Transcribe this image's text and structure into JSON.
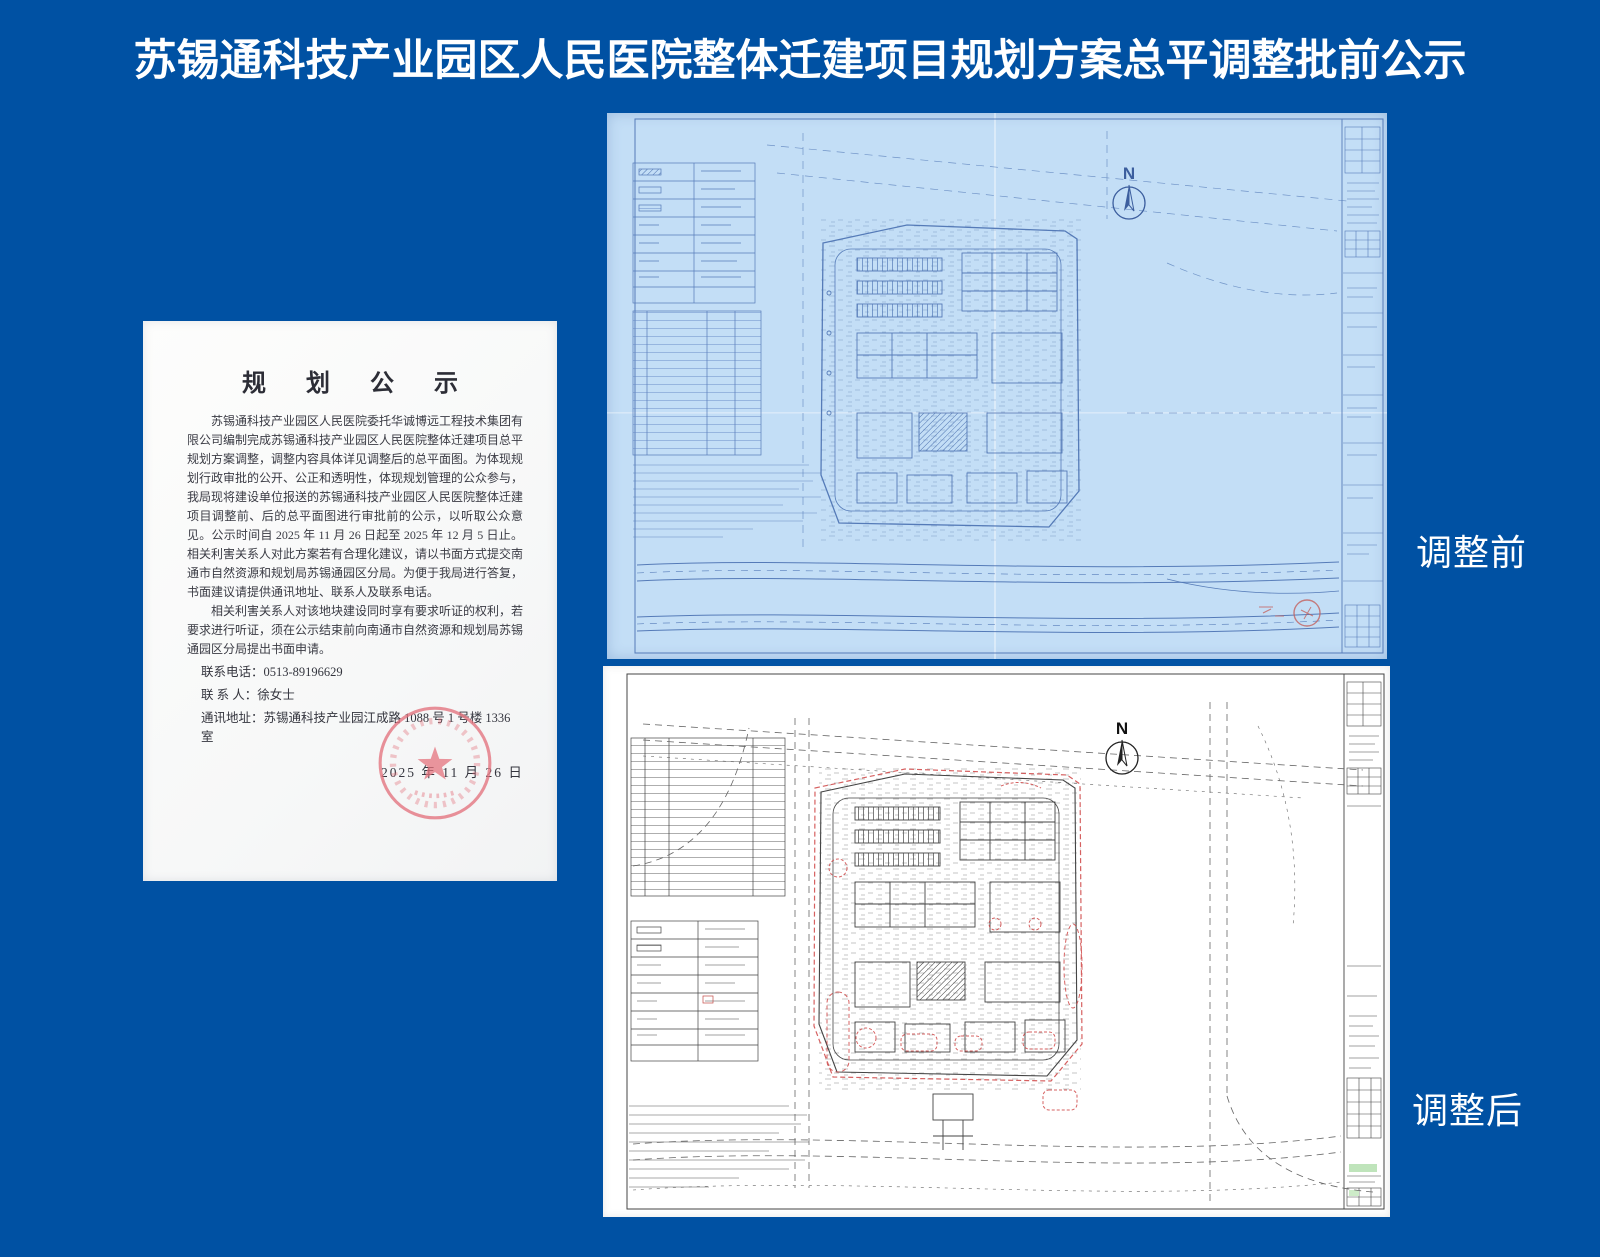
{
  "page": {
    "title": "苏锡通科技产业园区人民医院整体迁建项目规划方案总平调整批前公示",
    "background_color": "#0051a3"
  },
  "notice_letter": {
    "heading": "规 划 公 示",
    "paragraphs": [
      "苏锡通科技产业园区人民医院委托华诚博远工程技术集团有限公司编制完成苏锡通科技产业园区人民医院整体迁建项目总平规划方案调整，调整内容具体详见调整后的总平面图。为体现规划行政审批的公开、公正和透明性，体现规划管理的公众参与，我局现将建设单位报送的苏锡通科技产业园区人民医院整体迁建项目调整前、后的总平面图进行审批前的公示，以听取公众意见。公示时间自 2025 年 11 月 26 日起至 2025 年 12 月 5 日止。相关利害关系人对此方案若有合理化建议，请以书面方式提交南通市自然资源和规划局苏锡通园区分局。为便于我局进行答复，书面建议请提供通讯地址、联系人及联系电话。",
      "相关利害关系人对该地块建设同时享有要求听证的权利，若要求进行听证，须在公示结束前向南通市自然资源和规划局苏锡通园区分局提出书面申请。"
    ],
    "contact_phone": "联系电话：0513-89196629",
    "contact_person": "联 系 人：徐女士",
    "contact_address": "通讯地址：苏锡通科技产业园江成路 1088 号 1 号楼 1336 室",
    "date": "2025 年 11 月 26 日"
  },
  "plans": {
    "before": {
      "label": "调整前",
      "north_label": "N"
    },
    "after": {
      "label": "调整后",
      "north_label": "N"
    }
  }
}
